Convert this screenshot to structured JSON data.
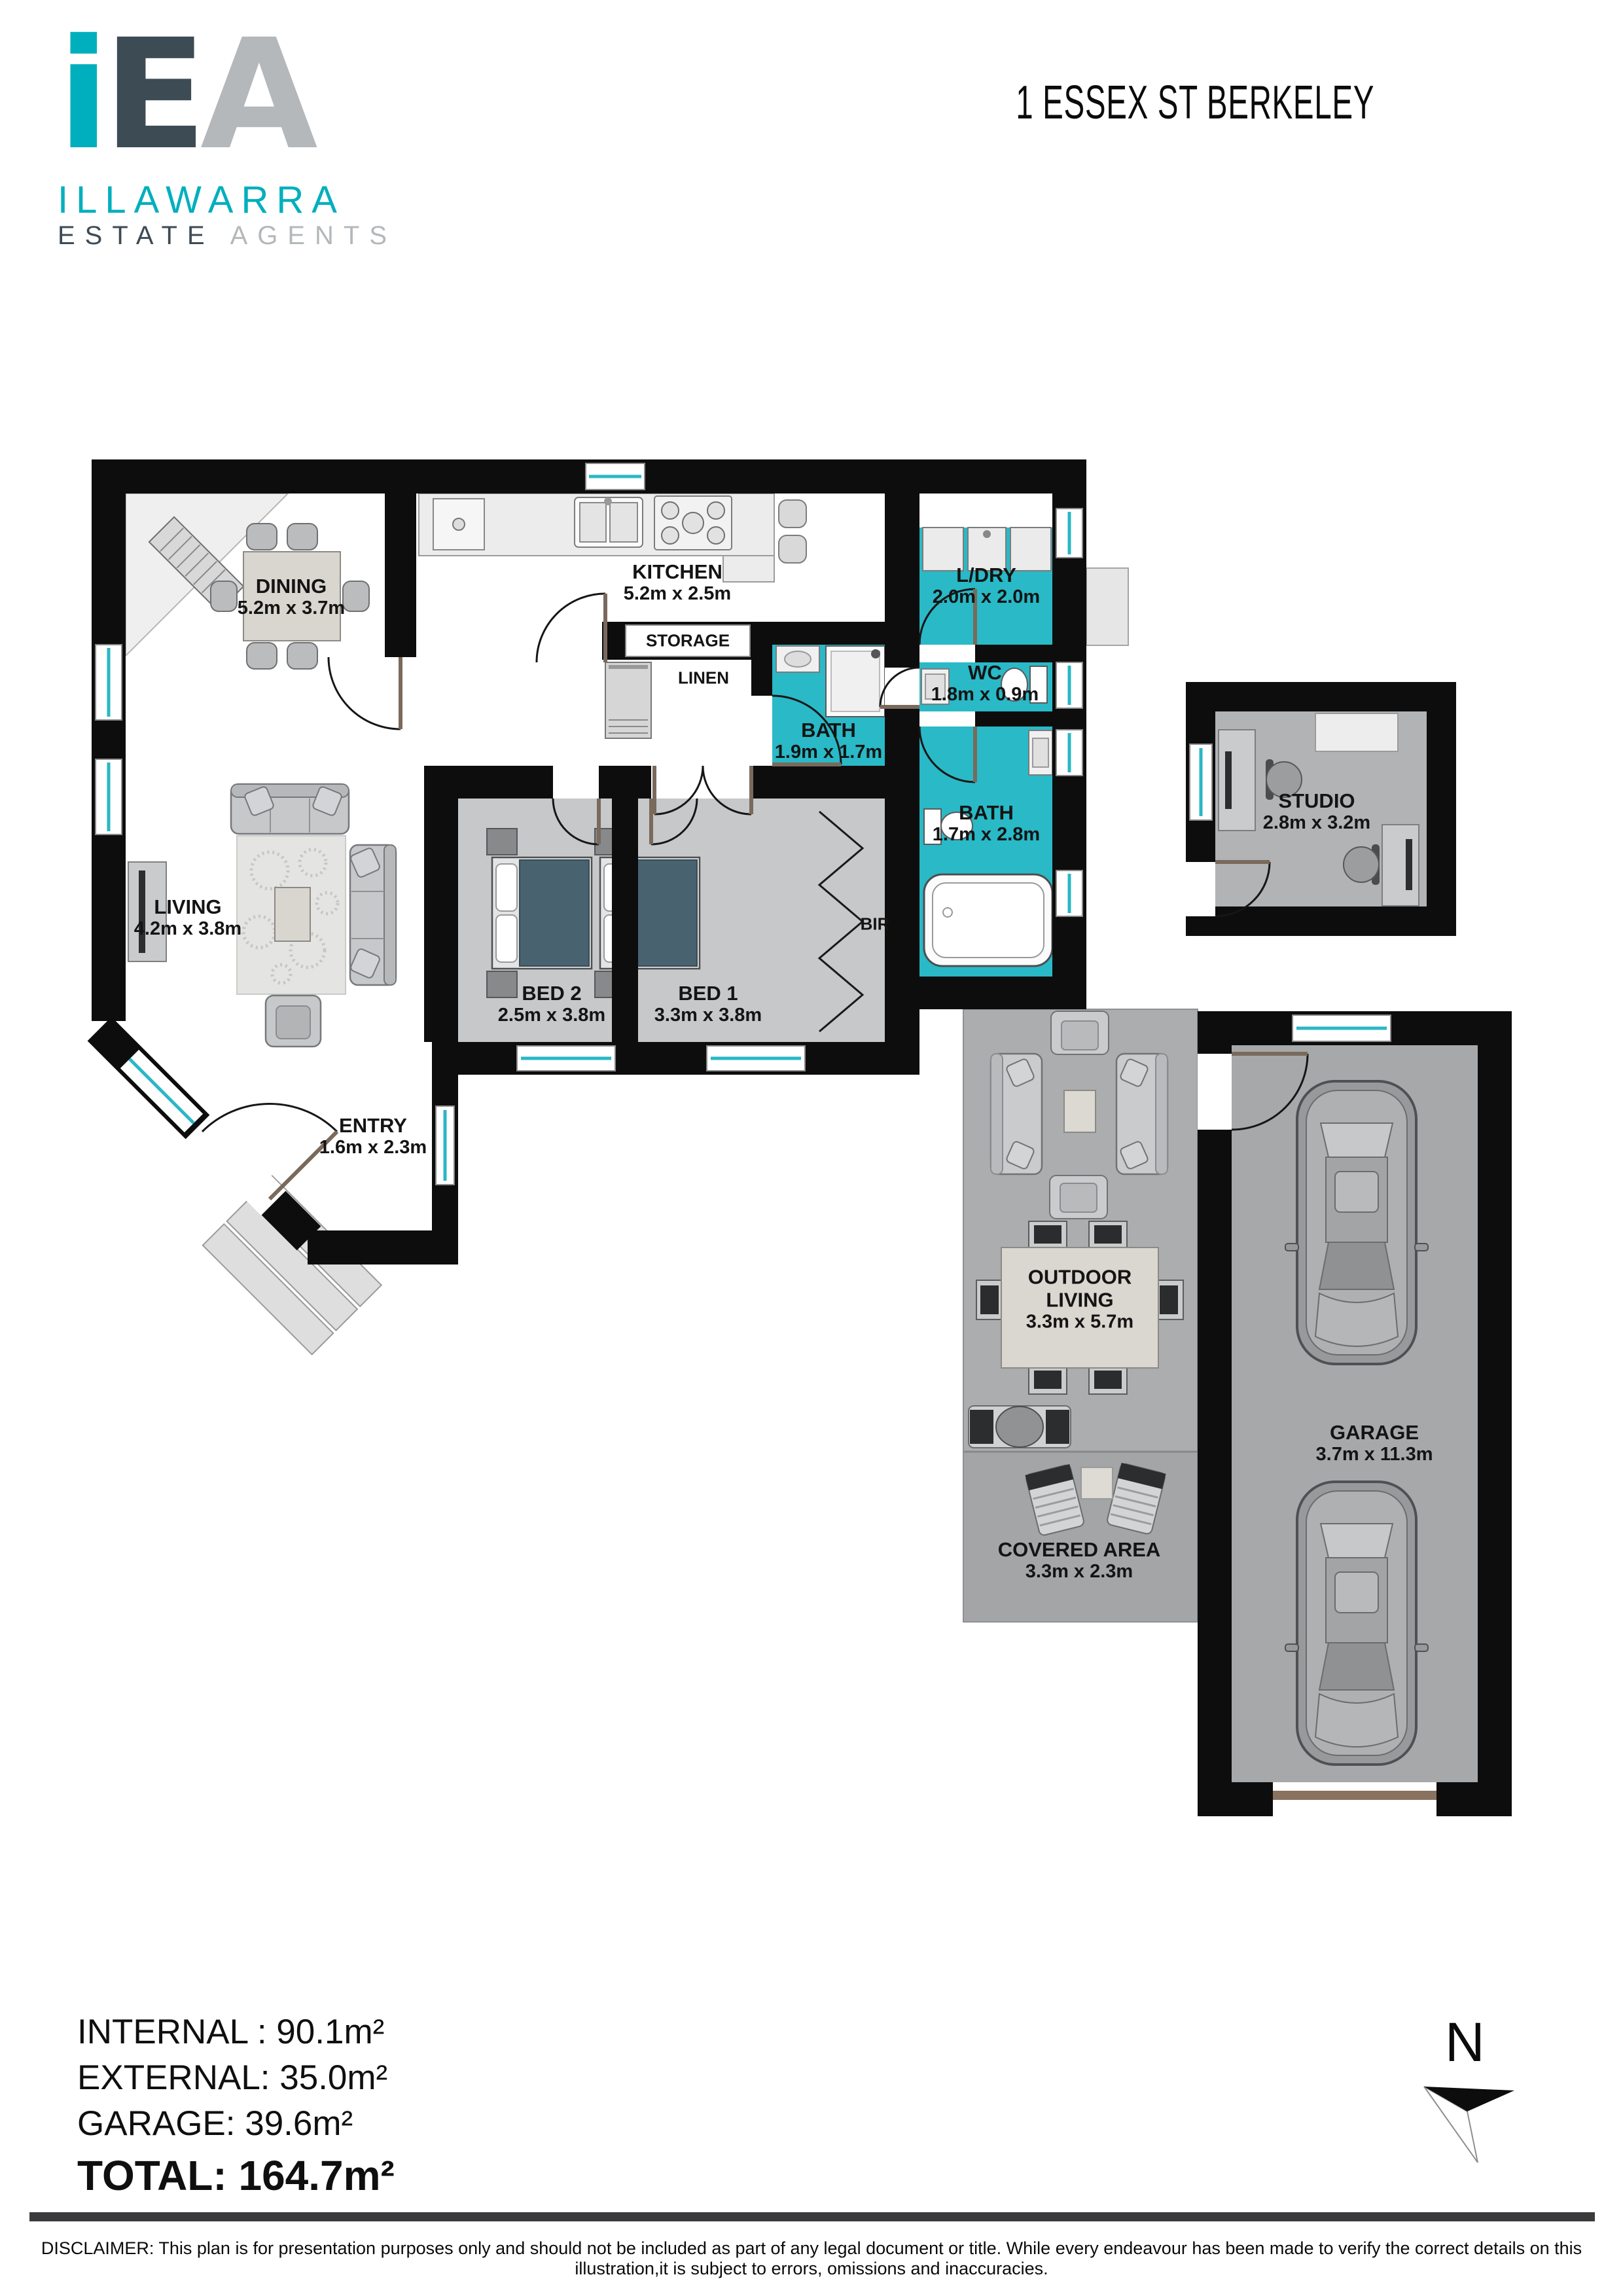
{
  "brand": {
    "mark_i": "i",
    "mark_e": "E",
    "mark_a": "A",
    "line1": "ILLAWARRA",
    "line2a": "ESTATE",
    "line2b": "AGENTS"
  },
  "title": "1 ESSEX ST BERKELEY",
  "rooms": [
    {
      "id": "dining",
      "name": "DINING",
      "dims": "5.2m x 3.7m"
    },
    {
      "id": "kitchen",
      "name": "KITCHEN",
      "dims": "5.2m x 2.5m"
    },
    {
      "id": "storage",
      "name": "STORAGE",
      "dims": ""
    },
    {
      "id": "linen",
      "name": "LINEN",
      "dims": ""
    },
    {
      "id": "ldry",
      "name": "L/DRY",
      "dims": "2.0m x 2.0m"
    },
    {
      "id": "wc",
      "name": "WC",
      "dims": "1.8m x 0.9m"
    },
    {
      "id": "bath1",
      "name": "BATH",
      "dims": "1.9m x 1.7m"
    },
    {
      "id": "bath2",
      "name": "BATH",
      "dims": "1.7m x 2.8m"
    },
    {
      "id": "studio",
      "name": "STUDIO",
      "dims": "2.8m x 3.2m"
    },
    {
      "id": "living",
      "name": "LIVING",
      "dims": "4.2m x 3.8m"
    },
    {
      "id": "bed2",
      "name": "BED 2",
      "dims": "2.5m x 3.8m"
    },
    {
      "id": "bed1",
      "name": "BED 1",
      "dims": "3.3m x 3.8m"
    },
    {
      "id": "bir",
      "name": "BIR",
      "dims": ""
    },
    {
      "id": "entry",
      "name": "ENTRY",
      "dims": "1.6m x 2.3m"
    },
    {
      "id": "outdoor",
      "name": "OUTDOOR LIVING",
      "dims": "3.3m x 5.7m"
    },
    {
      "id": "covered",
      "name": "COVERED AREA",
      "dims": "3.3m x 2.3m"
    },
    {
      "id": "garage",
      "name": "GARAGE",
      "dims": "3.7m x 11.3m"
    }
  ],
  "areas": {
    "internal": "INTERNAL : 90.1m²",
    "external": "EXTERNAL: 35.0m²",
    "garage": "GARAGE: 39.6m²",
    "total": "TOTAL: 164.7m²"
  },
  "compass": {
    "north": "N"
  },
  "disclaimer": "DISCLAIMER: This plan is for presentation purposes only and should not be included as part of any legal document or title. While every endeavour has been made to verify the correct details on this illustration,it is subject to errors, omissions and inaccuracies.",
  "colors": {
    "teal": "#00afbd",
    "slate": "#3d4b55",
    "silver": "#b4b8bb",
    "wet": "#29b9c7",
    "wall": "#0d0d0d",
    "window": "#2ab7c5"
  }
}
